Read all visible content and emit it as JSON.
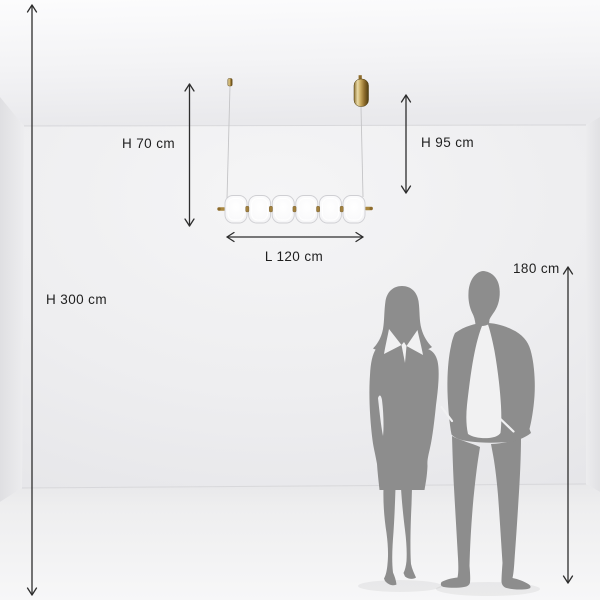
{
  "scene": {
    "kind": "product dimension diagram",
    "product": "linear glass pendant lamp",
    "figures": [
      "woman silhouette",
      "man silhouette"
    ]
  },
  "lamp": {
    "shade_count": 6,
    "suspensions": 2
  },
  "dimensions": {
    "room_height": "H 300 cm",
    "drop_left": "H 70 cm",
    "drop_right": "H 95 cm",
    "lamp_length": "L 120 cm",
    "person_height": "180 cm"
  },
  "colors": {
    "wall": "#eeeef0",
    "ceiling": "#f6f6f8",
    "floor": "#f2f2f3",
    "silhouette": "#8d8d8d",
    "dimension_line": "#2d2d2d",
    "label_text": "#1f1f1f",
    "brass": "#a9873f",
    "glass": "#fdfdfe"
  }
}
